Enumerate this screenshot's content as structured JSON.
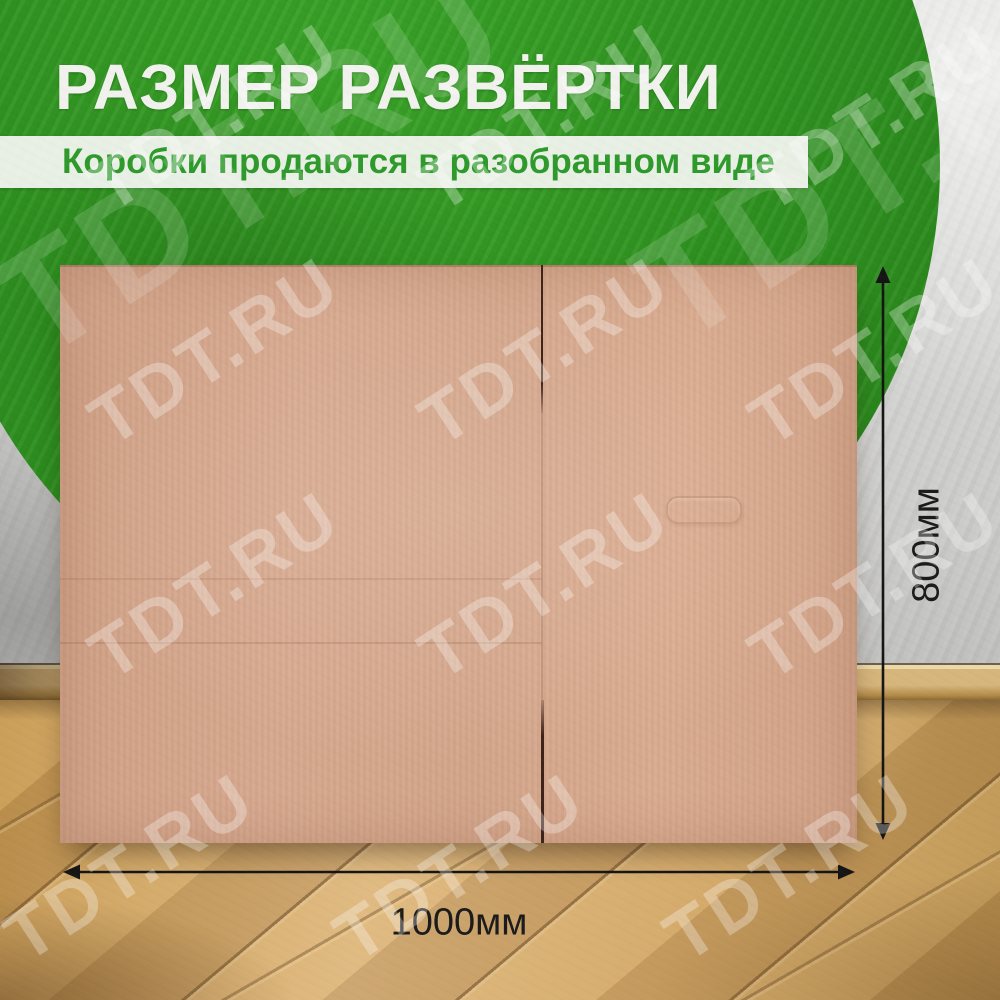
{
  "header": {
    "title": "РАЗМЕР РАЗВЁРТКИ",
    "subtitle": "Коробки продаются в разобранном виде"
  },
  "dimensions": {
    "width_label": "1000мм",
    "height_label": "800мм"
  },
  "watermark": {
    "text": "TDT.RU",
    "positions": [
      {
        "x": 215,
        "y": 118
      },
      {
        "x": 545,
        "y": 118
      },
      {
        "x": 875,
        "y": 118
      },
      {
        "x": 215,
        "y": 352
      },
      {
        "x": 545,
        "y": 352
      },
      {
        "x": 875,
        "y": 352
      },
      {
        "x": 215,
        "y": 586
      },
      {
        "x": 545,
        "y": 586
      },
      {
        "x": 875,
        "y": 586
      },
      {
        "x": 130,
        "y": 868
      },
      {
        "x": 460,
        "y": 868
      },
      {
        "x": 790,
        "y": 868
      }
    ],
    "large_positions": [
      {
        "x": 250,
        "y": 165
      },
      {
        "x": 890,
        "y": 150
      }
    ]
  },
  "colors": {
    "accent_green": "#2f9220",
    "green_dark": "#27841a",
    "title_text": "#f1f1ee",
    "subtitle_text": "#2f9a2c",
    "banner_bg": "rgba(246,246,243,0.93)",
    "cardboard": "#d5a78c",
    "cardboard_seam": "#3f231b",
    "wall_light": "#e6e6e4",
    "wall_dark": "#a5a5a3",
    "floor_light": "#dcb67e",
    "floor_dark": "#b8904f",
    "dimension_text": "#1b1b1b",
    "watermark_color": "rgba(255,255,255,0.30)"
  }
}
